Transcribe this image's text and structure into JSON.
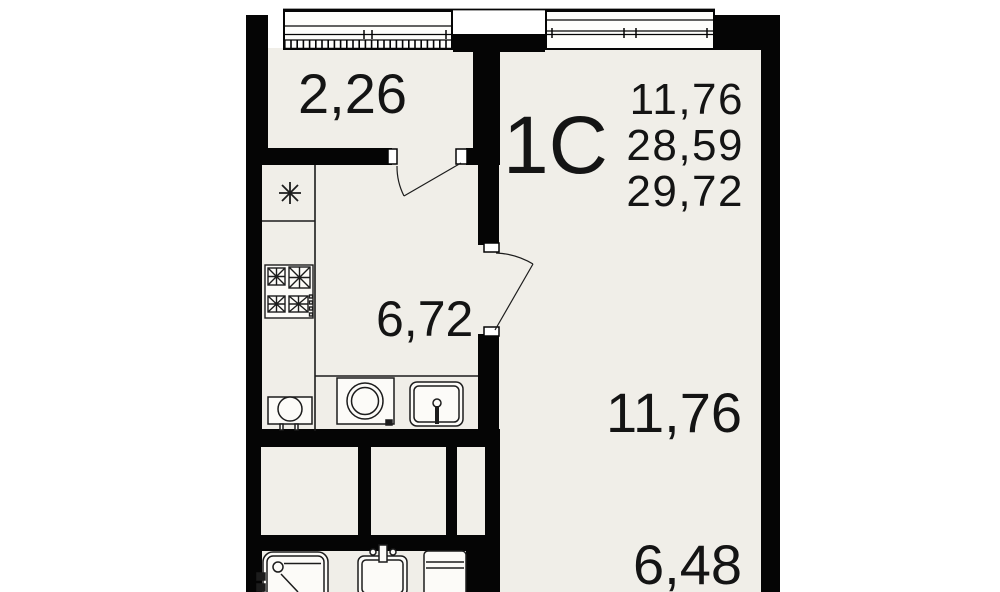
{
  "floor_plan": {
    "unit_type_label": "1С",
    "area_summary": {
      "living_area": "11,76",
      "total_area": "28,59",
      "total_area_with_balcony": "29,72"
    },
    "room_areas": {
      "balcony": "2,26",
      "kitchen": "6,72",
      "living_room": "11,76",
      "hallway": "6,48"
    },
    "colors": {
      "wall": "#050505",
      "floor": "#f0eee8",
      "background": "#ffffff",
      "fixture_fill": "#fcfbf8",
      "text": "#141414"
    },
    "icons": [
      "snowflake-icon",
      "stove-icon",
      "boiler-icon",
      "washing-machine-icon",
      "kitchen-sink-icon",
      "bathtub-icon",
      "washbasin-icon",
      "toilet-icon",
      "window-icon",
      "door-arc-icon"
    ]
  }
}
